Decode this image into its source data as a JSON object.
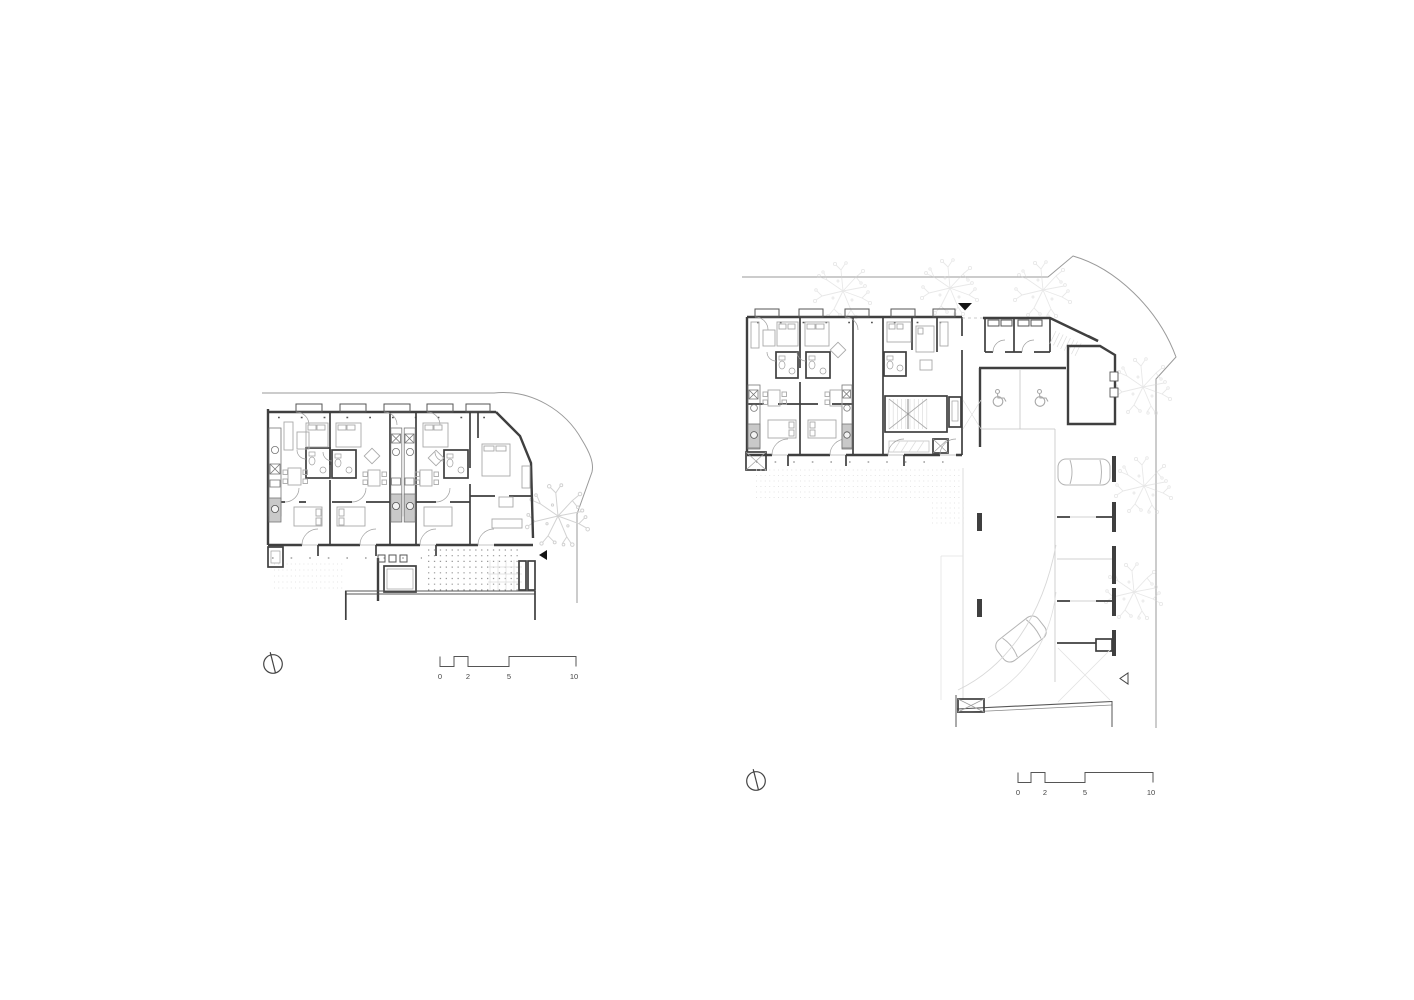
{
  "sheet": {
    "background": "#ffffff"
  },
  "palette": {
    "wall": "#3f3f3f",
    "partition": "#6a6a6a",
    "furniture": "#a9a9a9",
    "fixture_fill": "#c9c9c9",
    "site_line": "#9a9a9a",
    "tree": "#d2d2d2",
    "label_text": "#444444",
    "entrance_marker": "#141414"
  },
  "left_plan": {
    "scale_bar": {
      "labels": [
        "0",
        "2",
        "5",
        "10"
      ]
    },
    "icons": [
      "north-arrow-icon",
      "entrance-arrow-icon",
      "tree-icon"
    ]
  },
  "right_plan": {
    "scale_bar": {
      "labels": [
        "0",
        "2",
        "5",
        "10"
      ]
    },
    "icons": [
      "north-arrow-icon",
      "entrance-arrow-icon",
      "exit-arrow-icon",
      "wheelchair-icon",
      "wheelchair-icon",
      "car-icon",
      "car-icon",
      "tree-icon"
    ]
  }
}
